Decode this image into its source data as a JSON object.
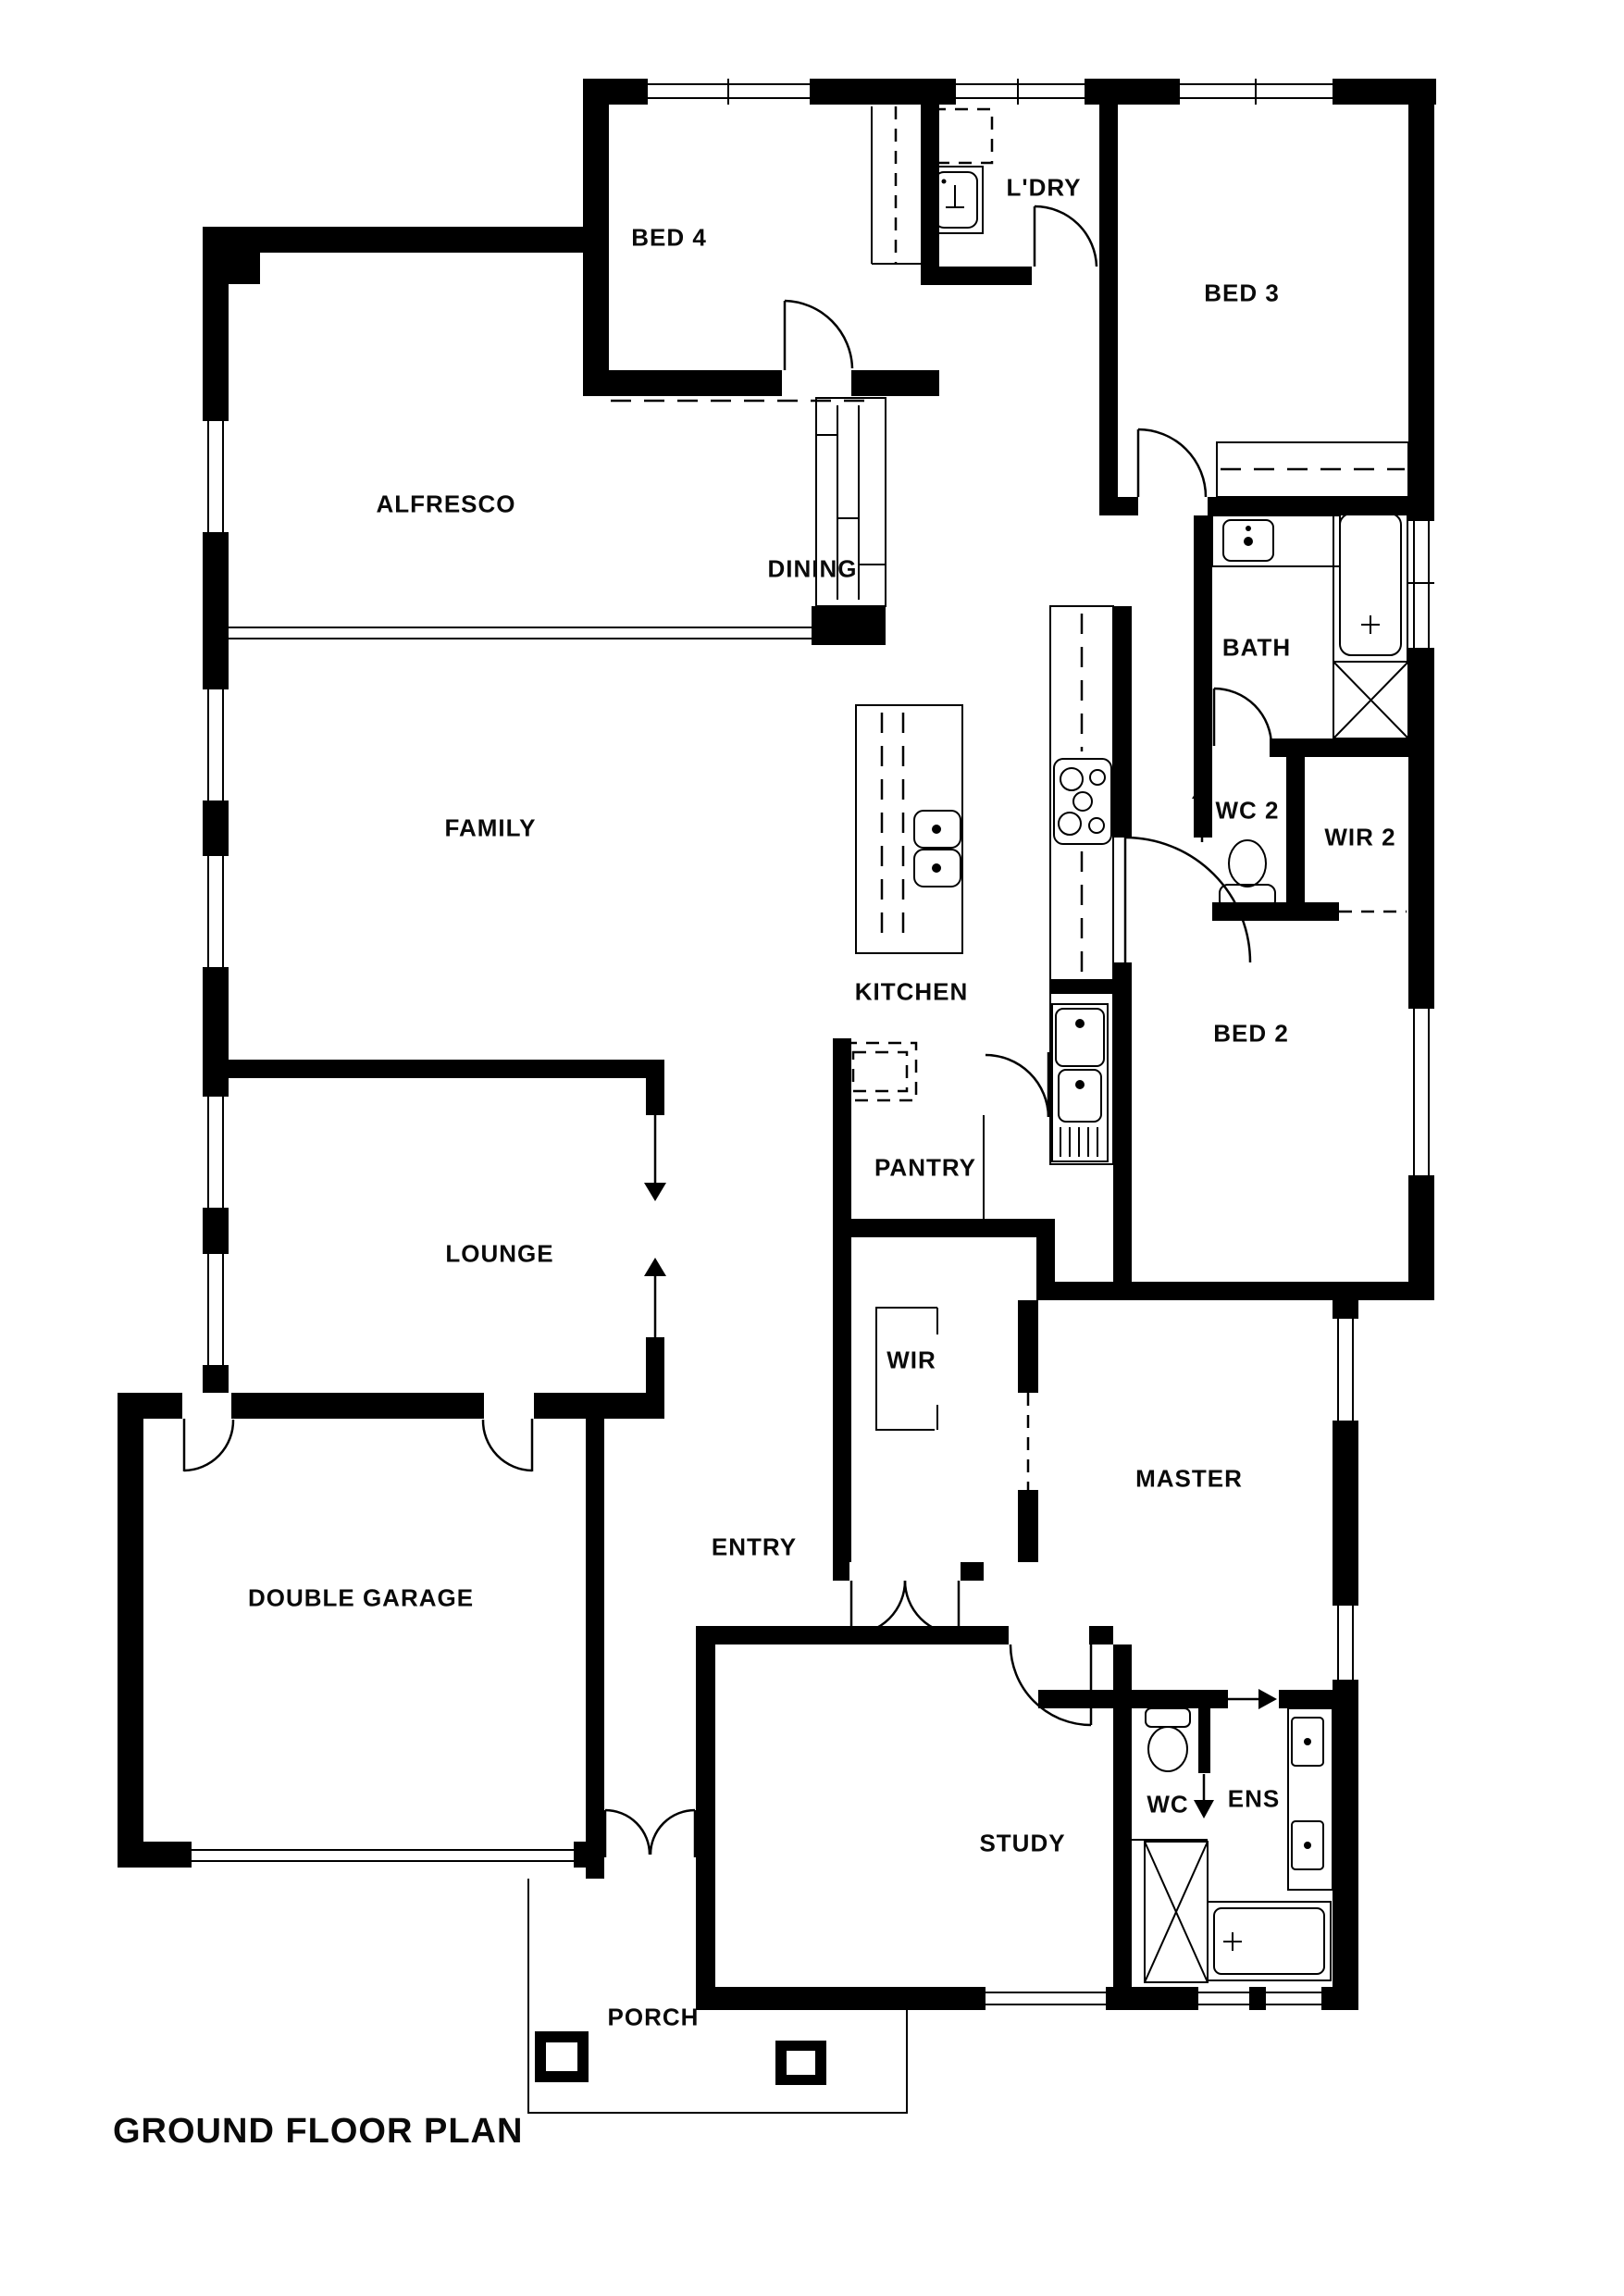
{
  "title": "GROUND FLOOR PLAN",
  "rooms": {
    "bed4": "BED 4",
    "ldry": "L'DRY",
    "bed3": "BED 3",
    "alfresco": "ALFRESCO",
    "dining": "DINING",
    "bath": "BATH",
    "family": "FAMILY",
    "wc2": "WC 2",
    "wir2": "WIR 2",
    "kitchen": "KITCHEN",
    "bed2": "BED 2",
    "pantry": "PANTRY",
    "lounge": "LOUNGE",
    "wir": "WIR",
    "master": "MASTER",
    "entry": "ENTRY",
    "garage": "DOUBLE GARAGE",
    "study": "STUDY",
    "wc": "WC",
    "ens": "ENS",
    "porch": "PORCH"
  },
  "colors": {
    "wall": "#000000",
    "background": "#ffffff"
  }
}
